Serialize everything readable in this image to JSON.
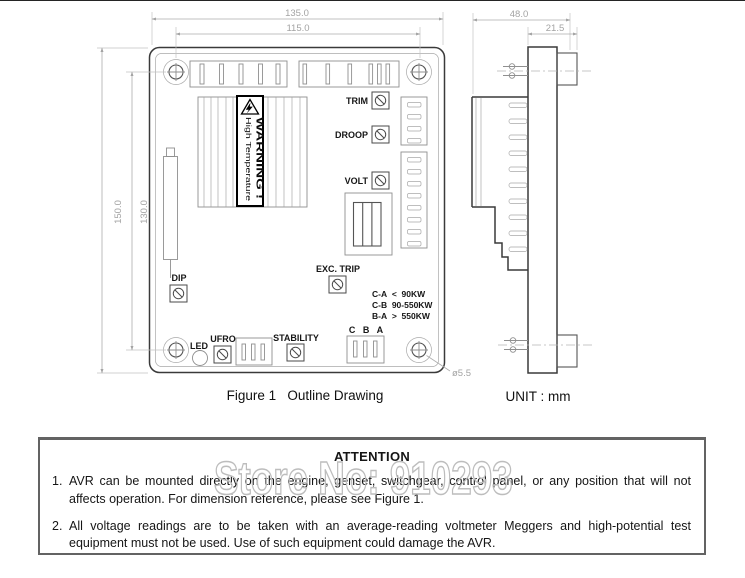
{
  "colors": {
    "line": "#3a3a3a",
    "light_line": "#8f8f8f",
    "dim_line": "#adadad",
    "text": "#161616",
    "watermark": "#bdbdbd"
  },
  "figure": {
    "caption": "Figure 1   Outline Drawing",
    "unit": "UNIT : mm"
  },
  "front_view": {
    "dimensions": {
      "overall_width": "135.0",
      "hole_span_width": "115.0",
      "overall_height": "150.0",
      "hole_span_height": "130.0",
      "hole_diameter": "ø5.5"
    },
    "labels": {
      "trim": "TRIM",
      "droop": "DROOP",
      "volt": "VOLT",
      "exc_trip": "EXC. TRIP",
      "dip": "DIP",
      "led": "LED",
      "ufro": "UFRO",
      "stability": "STABILITY",
      "cba": "C   B   A"
    },
    "warning_label": {
      "line1": "WARNING !",
      "line2": "High Temperature"
    },
    "ratings": [
      "C-A  <  90KW",
      "C-B  90-550KW",
      "B-A  >  550KW"
    ]
  },
  "side_view": {
    "dimensions": {
      "overall_depth": "48.0",
      "body_depth": "21.5"
    }
  },
  "attention": {
    "title": "ATTENTION",
    "items": [
      {
        "num": "1.",
        "text": "AVR can be mounted directly on the engine, genset, switchgear, control panel, or any position that will not affects operation. For dimension reference, please see Figure 1."
      },
      {
        "num": "2.",
        "text": "All voltage readings are to be taken with an average-reading voltmeter Meggers and high-potential test equipment must not be used. Use of such equipment could damage the AVR."
      }
    ]
  },
  "watermark": "Store No: 910293"
}
